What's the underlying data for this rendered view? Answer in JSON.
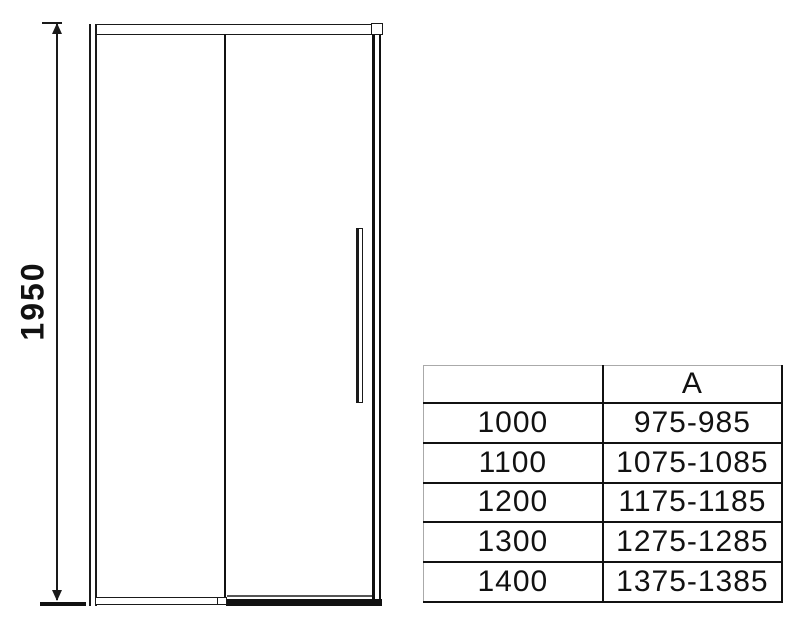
{
  "page": {
    "background": "#ffffff",
    "line_color": "#111111"
  },
  "drawing": {
    "name": "sliding-shower-door-front-view",
    "height_dimension": "1950"
  },
  "table": {
    "header": [
      "",
      "A"
    ],
    "rows": [
      [
        "1000",
        "975-985"
      ],
      [
        "1100",
        "1075-1085"
      ],
      [
        "1200",
        "1175-1185"
      ],
      [
        "1300",
        "1275-1285"
      ],
      [
        "1400",
        "1375-1385"
      ]
    ]
  }
}
